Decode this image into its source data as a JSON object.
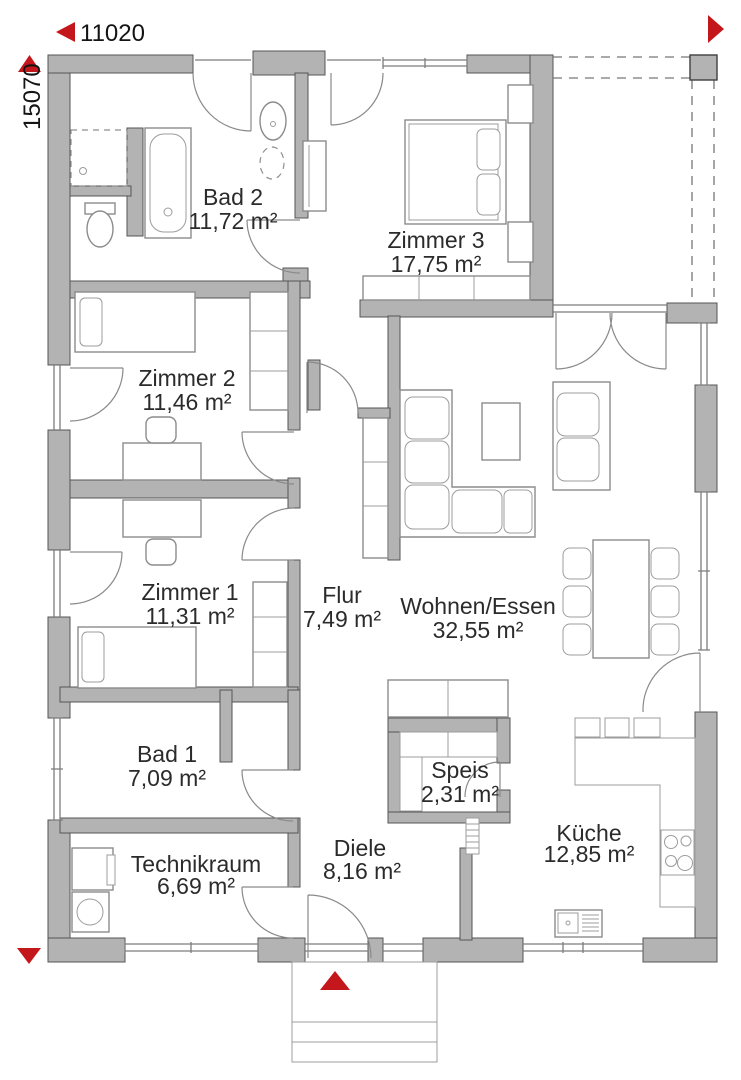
{
  "dimensions": {
    "width_label": "11020",
    "height_label": "15070"
  },
  "rooms": [
    {
      "id": "bad2",
      "name": "Bad 2",
      "area": "11,72 m²"
    },
    {
      "id": "zimmer3",
      "name": "Zimmer 3",
      "area": "17,75 m²"
    },
    {
      "id": "zimmer2",
      "name": "Zimmer 2",
      "area": "11,46 m²"
    },
    {
      "id": "zimmer1",
      "name": "Zimmer 1",
      "area": "11,31 m²"
    },
    {
      "id": "flur",
      "name": "Flur",
      "area": "7,49 m²"
    },
    {
      "id": "wohnen",
      "name": "Wohnen/Essen",
      "area": "32,55 m²"
    },
    {
      "id": "bad1",
      "name": "Bad 1",
      "area": "7,09 m²"
    },
    {
      "id": "speis",
      "name": "Speis",
      "area": "2,31 m²"
    },
    {
      "id": "technikraum",
      "name": "Technikraum",
      "area": "6,69 m²"
    },
    {
      "id": "diele",
      "name": "Diele",
      "area": "8,16 m²"
    },
    {
      "id": "kueche",
      "name": "Küche",
      "area": "12,85 m²"
    }
  ],
  "colors": {
    "wall": "#b3b3b3",
    "accent_red": "#c4171c",
    "text": "#2b2b2b",
    "furniture_line": "#8c8c8c"
  }
}
